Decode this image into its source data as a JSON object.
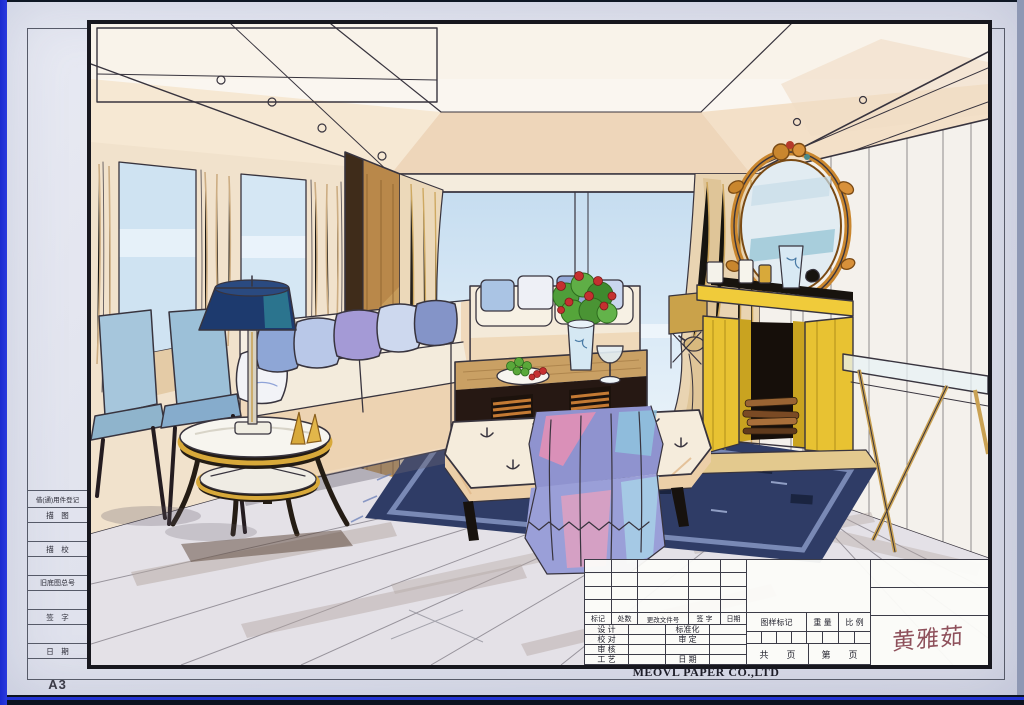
{
  "sheet": {
    "format_label": "A3",
    "company_name": "MEOVL PAPER CO.,LTD",
    "signature": "黄雅茹"
  },
  "left_column": {
    "rows": [
      "借(通)用件登记",
      "描　图",
      "",
      "描　校",
      "",
      "旧底图总号",
      "",
      "签　字",
      "",
      "日　期",
      ""
    ]
  },
  "title_block": {
    "revision_columns": [
      "标记",
      "处数",
      "更改文件号",
      "签 字",
      "日期"
    ],
    "staff_rows": [
      [
        "设 计",
        "标准化"
      ],
      [
        "校 对",
        "审 定"
      ],
      [
        "审 核",
        ""
      ],
      [
        "工 艺",
        "日 期"
      ]
    ],
    "mark_label": "图样标记",
    "weight_label": "重 量",
    "scale_label": "比 例",
    "pages_total_label": "共　　页",
    "pages_number_label": "第　　页"
  },
  "palette": {
    "photo_edge_blue": "#2233d4",
    "paper": "#e0e2ec",
    "ink": "#38343e",
    "curtain_tan": "#ecd9ba",
    "sky_blue": "#cfe4f4",
    "fireplace_yellow": "#eac836",
    "mirror_gold": "#c9862e",
    "rug_navy": "#2f3c66",
    "sofa_cream": "#f4ead9",
    "lamp_navy": "#1d3a6e",
    "throw_pink": "#e88fb4",
    "signature_red": "#7c3340"
  }
}
